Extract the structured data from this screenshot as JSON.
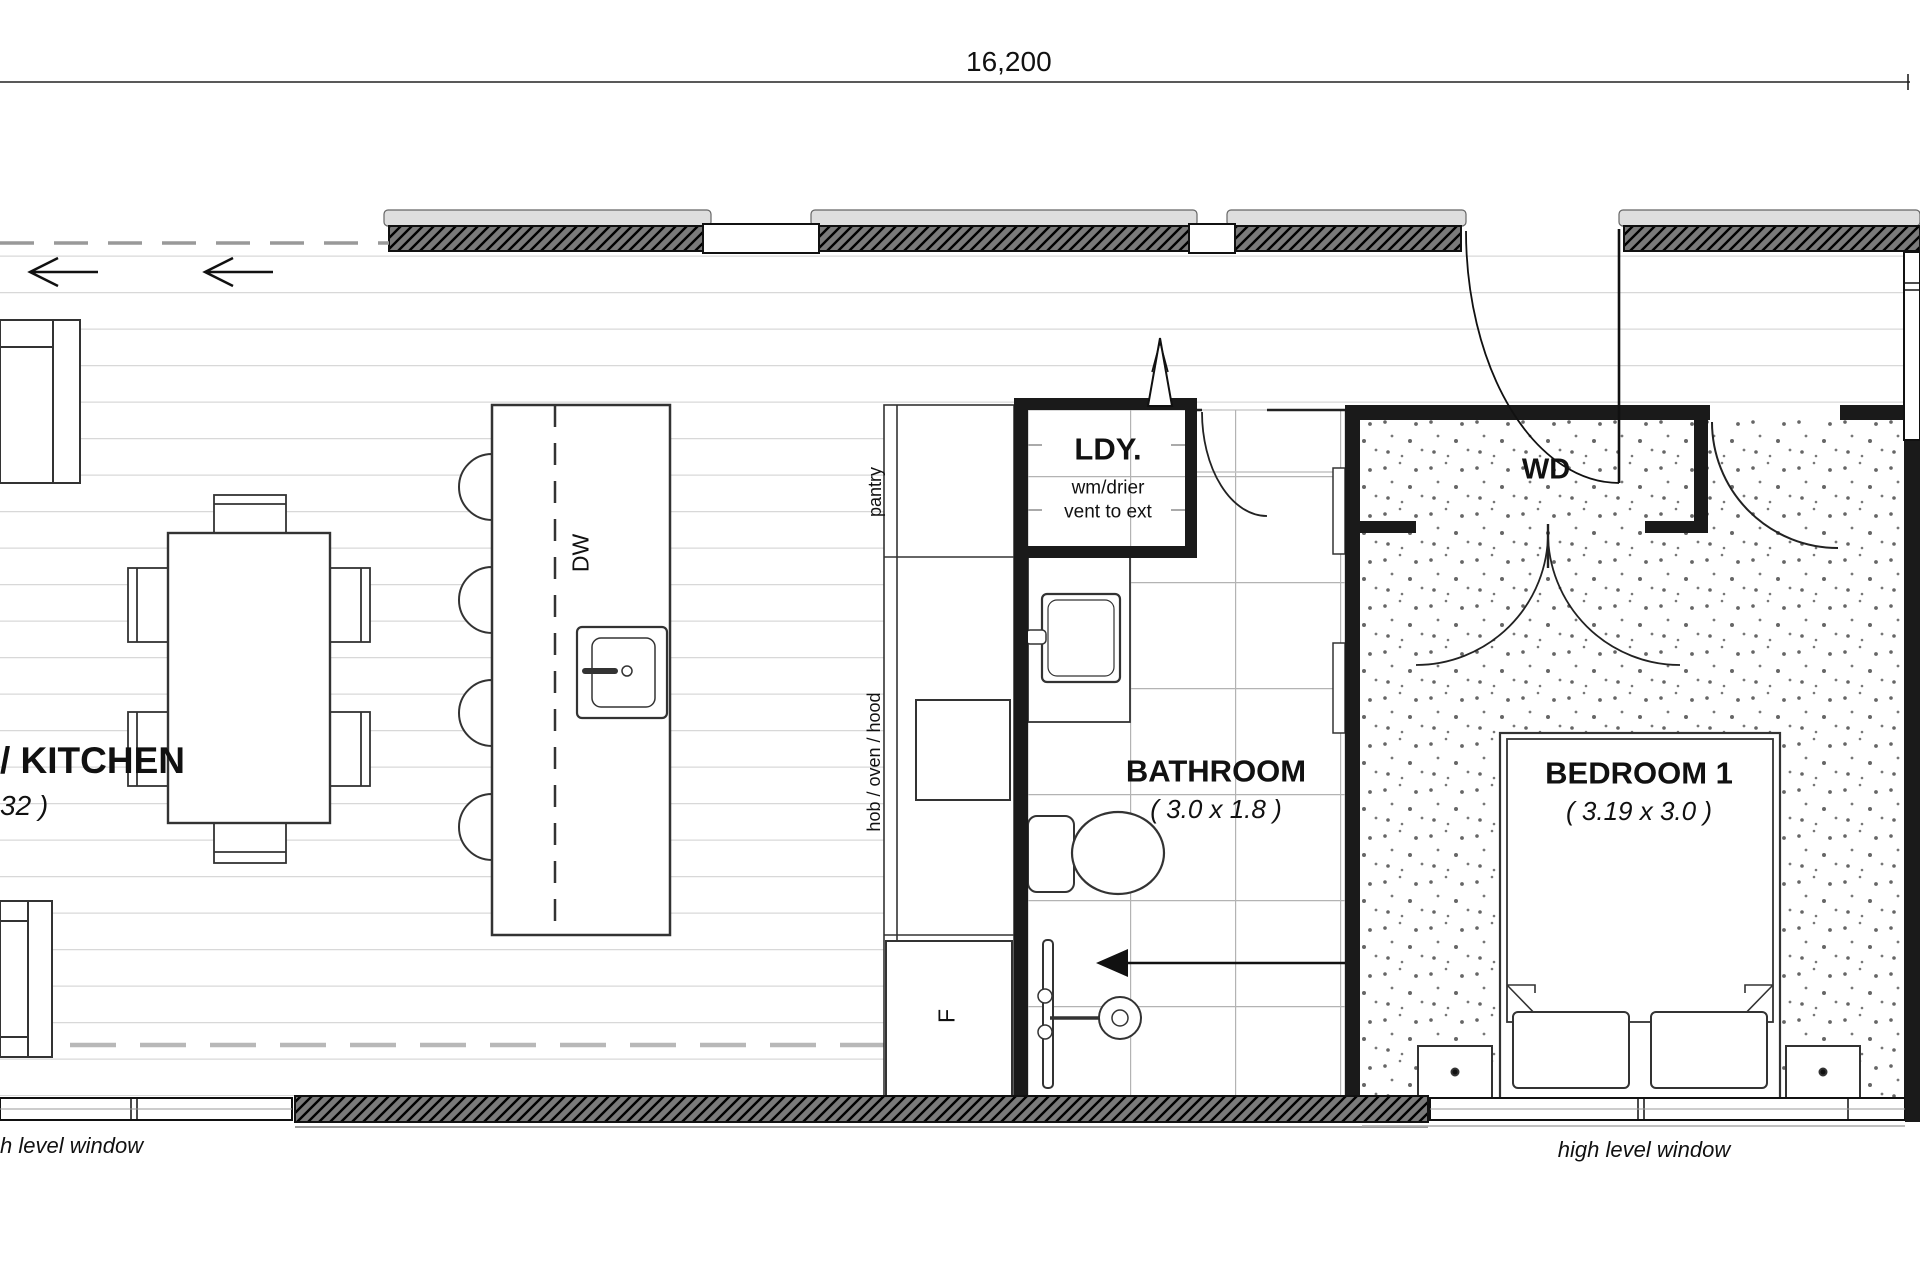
{
  "title": "floor-plan",
  "dimensions": {
    "overall_width": "16,200"
  },
  "rooms": {
    "kitchen": {
      "label": "/ KITCHEN",
      "dims": "32 )"
    },
    "laundry": {
      "label": "LDY.",
      "note_line1": "wm/drier",
      "note_line2": "vent to ext"
    },
    "bathroom": {
      "label": "BATHROOM",
      "dims": "( 3.0 x 1.8 )"
    },
    "bedroom": {
      "label": "BEDROOM 1",
      "dims": "( 3.19 x 3.0 )"
    },
    "wardrobe": {
      "label": "WD"
    }
  },
  "appliances": {
    "pantry": "pantry",
    "hob": "hob / oven / hood",
    "fridge": "F",
    "dishwasher": "DW"
  },
  "annotations": {
    "window_note_left": "h level window",
    "window_note_right": "high level window"
  },
  "colors": {
    "wall": "#1a1a1a",
    "hatch_fill": "#7a7a7a",
    "floor_line": "#d8d8d8",
    "tile_line": "#b3b3b3",
    "dashed_line": "#b8b8b8"
  }
}
